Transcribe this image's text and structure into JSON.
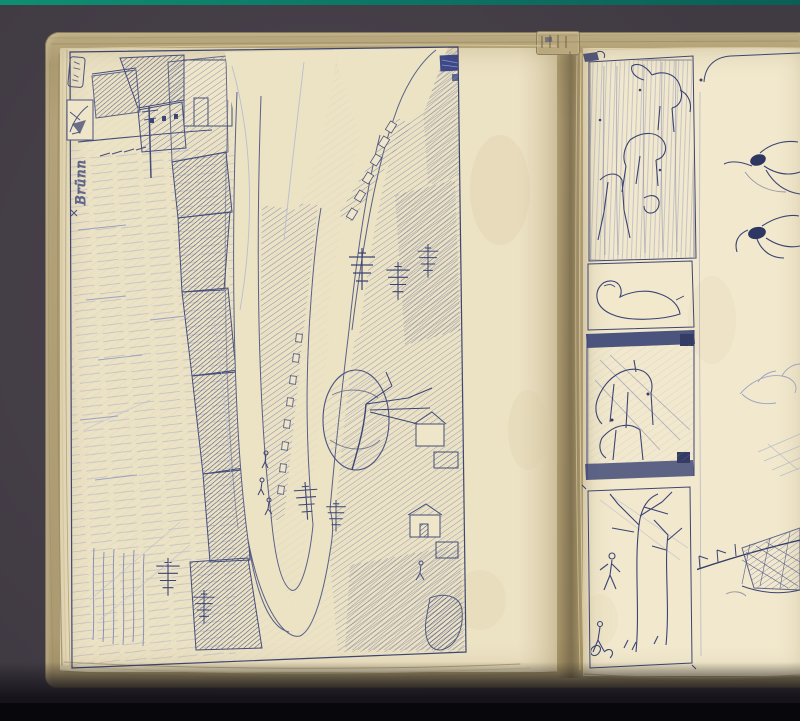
{
  "scene": {
    "kind": "scanned open sketchbook spread with blue ballpoint ink sketches",
    "colors": {
      "backdrop": "#4c454e",
      "teal1": "#0e8f72",
      "teal2": "#0a5f54",
      "black": "#08070b",
      "cover": "#b3a27a",
      "pageL": "#ece2c4",
      "pageR": "#f1e8cd",
      "ink": "#3b4474",
      "ink_light": "#9aa2c2",
      "panel_band": "#4b547c"
    },
    "left_page": {
      "margin_annotation": "Brünn",
      "sketch_label": "rotated landscape: hairpin road between hatched fields, village houses, firs, round tree"
    },
    "right_page": {
      "panels": [
        "horses and figures study with vertical streaks",
        "standing figure outline (rotated)",
        "dark-framed vignette with horses",
        "spindly trees with small figures",
        "figure studies with dark heads",
        "reclining figure study",
        "boat with rigging and crosshatch"
      ]
    }
  }
}
